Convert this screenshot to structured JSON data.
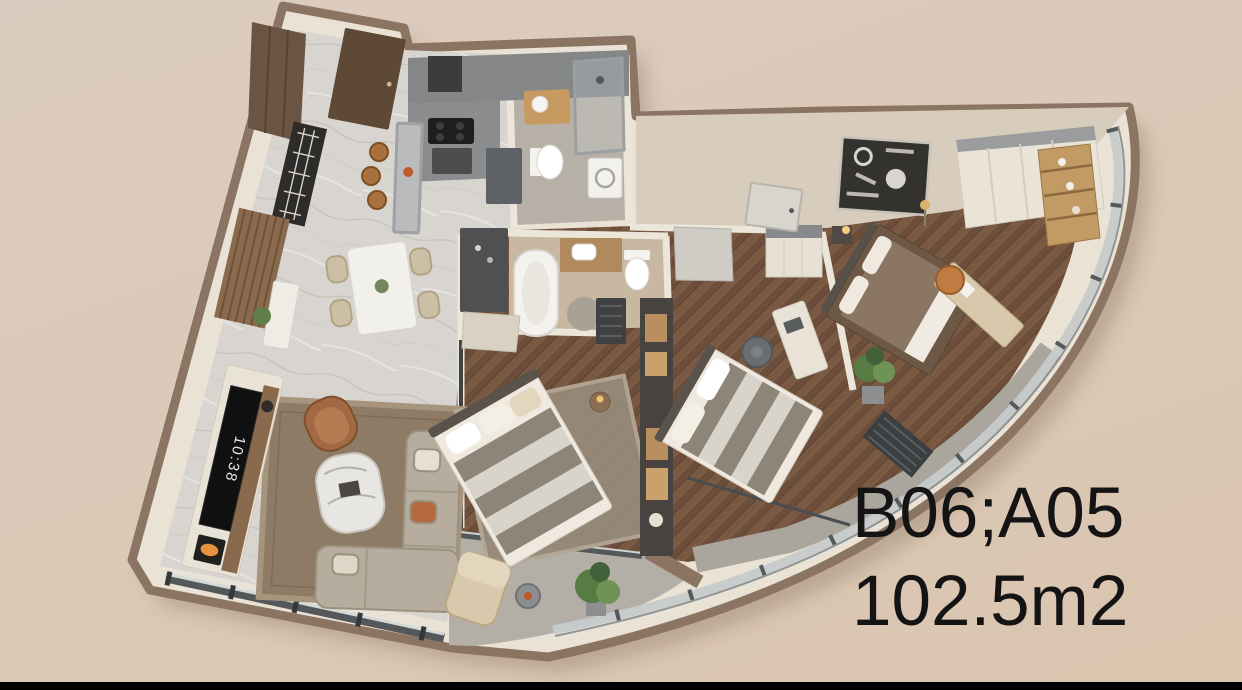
{
  "scene": {
    "type": "3d-floorplan-render",
    "background_top": "#dcccbf",
    "background_bottom": "#dac5ae",
    "bottom_bar_color": "#000000"
  },
  "annotation": {
    "unit_code": "B06;A05",
    "area": "102.5m2",
    "text_color": "#141414"
  },
  "floorplan": {
    "tv_clock": "10:38",
    "palette": {
      "outer_rim": "#8c7462",
      "wall": "#e9e2d5",
      "wall_face": "#d8cdbc",
      "marble_floor": "#d8d5d0",
      "wood_floor": "#76563f",
      "tile_floor": "#b7b0a6",
      "balcony_floor": "#b3aea6",
      "glass": "#c6cbcb",
      "kitchen_gray": "#85878a",
      "sofa": "#b6ad9f",
      "living_rug": "#8d7b66",
      "master_bed": "#6d5846",
      "leather_accent": "#a16a44",
      "plant_green": "#567c43"
    },
    "rooms": [
      {
        "name": "entry-foyer"
      },
      {
        "name": "kitchen"
      },
      {
        "name": "dining-area"
      },
      {
        "name": "living-room"
      },
      {
        "name": "bathroom"
      },
      {
        "name": "master-bathroom"
      },
      {
        "name": "hallway"
      },
      {
        "name": "bedroom-center"
      },
      {
        "name": "bedroom-side"
      },
      {
        "name": "master-bedroom"
      },
      {
        "name": "balcony"
      },
      {
        "name": "loggia"
      }
    ]
  }
}
